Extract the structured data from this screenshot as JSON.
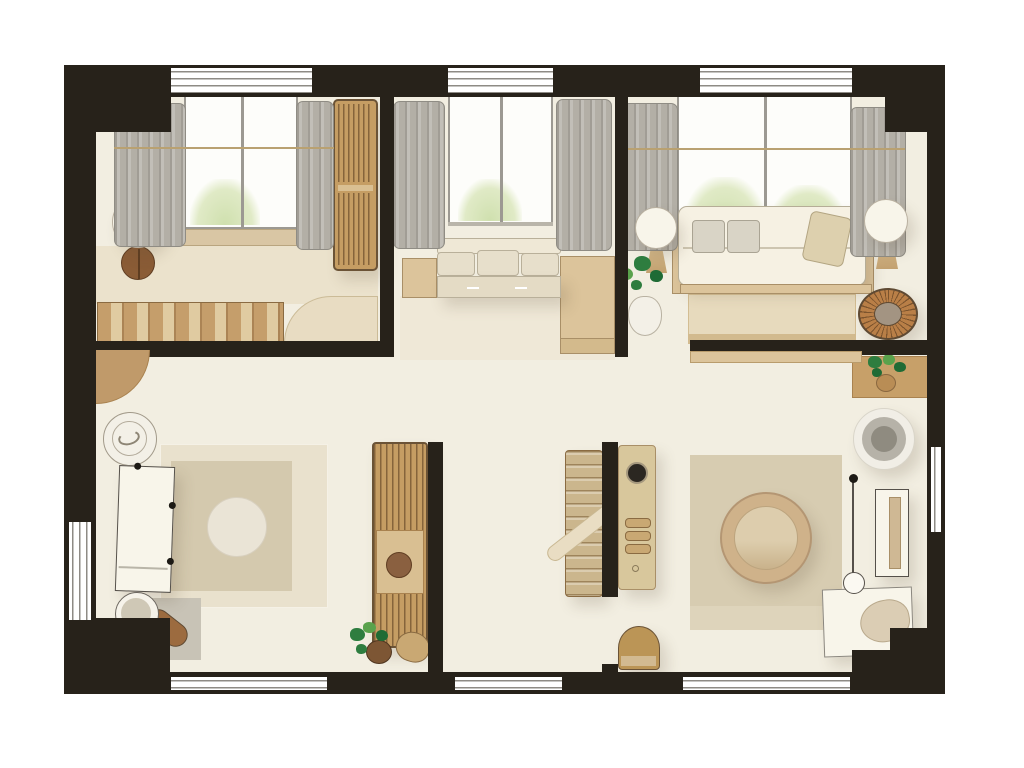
{
  "app": {
    "title": "Apartment floor plan - top view illustration"
  },
  "palette": {
    "wall": "#27221a",
    "floor": "#f2eee1",
    "floor_warm": "#ebe2cc",
    "wood": "#c59d63",
    "wood_dark": "#6b5336",
    "wood_mid": "#d9bf92",
    "wood_light": "#dcc49b",
    "cream": "#f6f1e3",
    "white_item": "#f8f5ea",
    "outline": "#55504a",
    "curtain": "#b3afa6",
    "curtain_edge": "#8f8c84",
    "glass_frame": "#9c9992",
    "glass_line": "#8e8b85",
    "sill": "#d9c6a4",
    "rug_light": "#e9e1cd",
    "rug_mid": "#d4c9ae",
    "rug_pale": "#eae4d6",
    "mat_gray": "#c8c3b6",
    "gray_item": "#b6b2a8",
    "gray_deep": "#8f8b80",
    "tan": "#c9a873",
    "rattan": "#b97f47",
    "brown": "#8a5c36",
    "pot": "#7d5634",
    "basket": "#b98d55",
    "green": "#2e7d3f",
    "green_light": "#5aa24c",
    "green_dark": "#1f6b35",
    "pillow_gray": "#d9d4c6",
    "pillow_beige": "#ddd0ae"
  },
  "rooms": {
    "bedroom": {
      "name": "bedroom",
      "items": [
        "window",
        "curtains",
        "slatted-wardrobe",
        "bedside-lamp-table",
        "platform-bed",
        "striped-bed-runner",
        "duvet",
        "door-swing"
      ]
    },
    "nook": {
      "name": "window-nook",
      "items": [
        "window",
        "curtains",
        "bench-cushions",
        "bench-drawers",
        "side-cabinets"
      ]
    },
    "living": {
      "name": "living-room",
      "items": [
        "window",
        "curtains",
        "sofa",
        "seat-cushions",
        "throw-pillow",
        "globe-lamps",
        "potted-plant",
        "coffee-mat",
        "rattan-chair"
      ]
    },
    "study": {
      "name": "study",
      "items": [
        "wall-clock",
        "white-desk",
        "desk-chair",
        "layered-rug",
        "gray-mat",
        "potted-plant",
        "door-arc"
      ]
    },
    "storage": {
      "name": "storage-aisle",
      "items": [
        "slatted-cabinet",
        "shelf-unit",
        "utility-cabinet",
        "ironing-board",
        "basket"
      ]
    },
    "lounge": {
      "name": "lounge",
      "items": [
        "plant-ledge",
        "pouf",
        "area-rug",
        "ring-chair",
        "floor-lamp",
        "side-table",
        "white-desk",
        "desk-chair",
        "half-stool"
      ]
    }
  }
}
